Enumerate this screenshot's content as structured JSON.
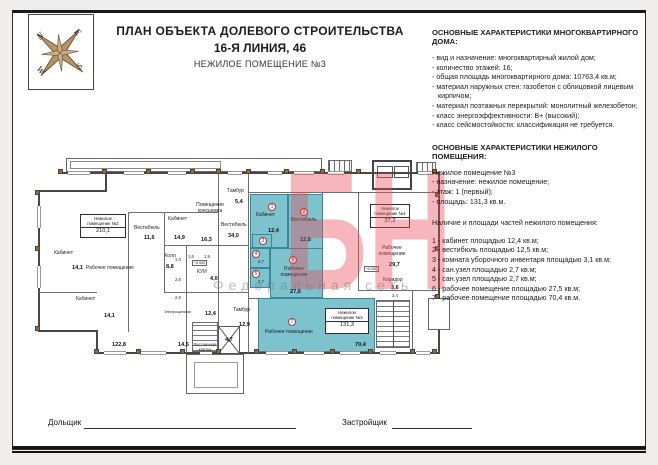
{
  "header": {
    "title1": "ПЛАН ОБЪЕКТА ДОЛЕВОГО СТРОИТЕЛЬСТВА",
    "title2": "16-Я ЛИНИЯ, 46",
    "title3": "НЕЖИЛОЕ ПОМЕЩЕНИЕ №3"
  },
  "compass": {
    "n": "N",
    "e": "E",
    "s": "S",
    "w": "W"
  },
  "right_panel": {
    "block1_heading": "ОСНОВНЫЕ ХАРАКТЕРИСТИКИ МНОГОКВАРТИРНОГО ДОМА:",
    "block1_items": [
      "- вид и назначение: многоквартирный жилой дом;",
      "- количество этажей: 16;",
      "- общая площадь многоквартирного дома: 10763,4 кв.м;",
      "- материал наружных стен: газобетон с облицовкой лицевым кирпичом;",
      "- материал поэтажных перекрытий: монолитный железобетон;",
      "- класс энергоэффективности: B+ (высокий);",
      "- класс сейсмостойкости: классификация не требуется."
    ],
    "block2_heading": "ОСНОВНЫЕ ХАРАКТЕРИСТИКИ НЕЖИЛОГО ПОМЕЩЕНИЯ:",
    "unit_title": "Нежилое помещение №3",
    "unit_items": [
      "- назначение: нежилое помещение;",
      "- этаж: 1 (первый);",
      "- площадь: 131,3 кв.м."
    ],
    "parts_heading": "Наличие и площади частей нежилого помещения:",
    "parts": [
      "1 - кабинет площадью 12,4 кв.м;",
      "2 - вестибюль площадью 12,5 кв.м;",
      "3 - комната уборочного инвентаря площадью 3,1 кв.м;",
      "4 - сан.узел площадью 2,7 кв.м;",
      "5 - сан.узел площадью 2,7 кв.м;",
      "6 - рабочее помещение площадью 27,5 кв.м;",
      "7 - рабочее помещение площадью 70,4 кв.м."
    ]
  },
  "plan": {
    "unit2": {
      "l1": "Нежилое",
      "l2": "помещение №2",
      "area": "210,1"
    },
    "unit3": {
      "l1": "Нежилое",
      "l2": "помещение №3",
      "area": "131,3"
    },
    "unit4": {
      "l1": "Нежилое",
      "l2": "помещение №4",
      "area": "37,2"
    },
    "rooms": {
      "cabA": {
        "name": "Кабинет",
        "area": "14,1"
      },
      "cabB": {
        "name": "Кабинет",
        "area": "14,1"
      },
      "rab2": {
        "name": "Рабочее помещение",
        "area": "122,8"
      },
      "vest2": {
        "name": "Вестибюль",
        "area": "11,6"
      },
      "cabC": {
        "name": "Кабинет",
        "area": "14,9"
      },
      "cabD": {
        "name": "Кабинет",
        "area": "15,1"
      },
      "concierge": {
        "name1": "Помещение",
        "name2": "консьержа",
        "area": "16,3"
      },
      "hall": {
        "name": "Холл",
        "area": "8,8"
      },
      "kui": {
        "name": "КУИ",
        "area": "4,0"
      },
      "elektro": {
        "name": "Электрощитовая",
        "area": "14,5"
      },
      "r124": {
        "area": "12,4"
      },
      "stairL": {
        "l1": "Лестничная",
        "l2": "клетка"
      },
      "lift": {
        "area": "4,7"
      },
      "tamburB": {
        "name": "Тамбур",
        "area": "12,9"
      },
      "tamburT": {
        "name": "Тамбур",
        "area": "5,4"
      },
      "vestC": {
        "name": "Вестибюль",
        "area": "34,0"
      },
      "u3r1": {
        "num": "1",
        "name": "Кабинет",
        "area": "12,4"
      },
      "u3r2": {
        "num": "2",
        "name": "Вестибюль",
        "area": "12,5"
      },
      "u3r3": {
        "num": "3"
      },
      "u3r4": {
        "num": "4",
        "area": "2,7"
      },
      "u3r5": {
        "num": "5",
        "area": "2,7"
      },
      "u3r6": {
        "num": "6",
        "name1": "Рабочее",
        "name2": "помещение",
        "area": "27,5"
      },
      "u3r7": {
        "num": "7",
        "name": "Рабочее помещение",
        "area": "70,4"
      },
      "u4rab": {
        "name1": "Рабочее",
        "name2": "помещение",
        "area": "29,7"
      },
      "u4kor": {
        "name": "Коридор",
        "area": "3,6"
      },
      "s10": "1,0",
      "s16": "1,6",
      "s19": "1,9",
      "s28": "2,8",
      "s29": "2,9",
      "s24": "2,4",
      "tag1": "+0.000",
      "tag2": "+0.000"
    }
  },
  "watermark": {
    "big": "БН",
    "text": "Федеральная сеть"
  },
  "footer": {
    "left_label": "Дольщик",
    "right_label": "Застройщик"
  },
  "colors": {
    "teal": "#7cc3ce",
    "watermark_red": "#e84955",
    "wood": "#8d6c49"
  }
}
